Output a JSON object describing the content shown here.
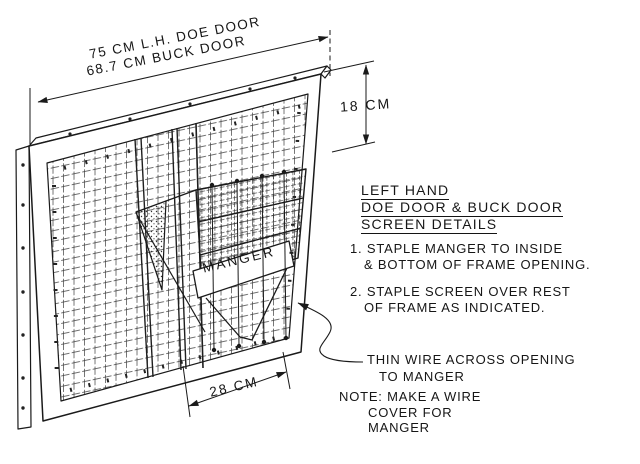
{
  "page": {
    "background": "#ffffff",
    "ink": "#1a1a1a"
  },
  "dimensions": {
    "top_line1": "75 CM L.H. DOE DOOR",
    "top_line2": "68.7 CM BUCK DOOR",
    "right": "18 CM",
    "bottom": "28 CM"
  },
  "labels": {
    "manger": "MANGER"
  },
  "title_block": {
    "line1": "LEFT HAND",
    "line2": "DOE DOOR & BUCK DOOR",
    "line3": "SCREEN DETAILS"
  },
  "note1": {
    "line1": "1. STAPLE MANGER TO INSIDE",
    "line2": "& BOTTOM OF FRAME OPENING."
  },
  "note2": {
    "line1": "2. STAPLE SCREEN OVER REST",
    "line2": "OF FRAME AS INDICATED."
  },
  "callout_wire": {
    "line1": "THIN WIRE ACROSS OPENING",
    "line2": "TO MANGER"
  },
  "callout_note": {
    "line1": "NOTE: MAKE A WIRE",
    "line2": "COVER FOR",
    "line3": "MANGER"
  }
}
